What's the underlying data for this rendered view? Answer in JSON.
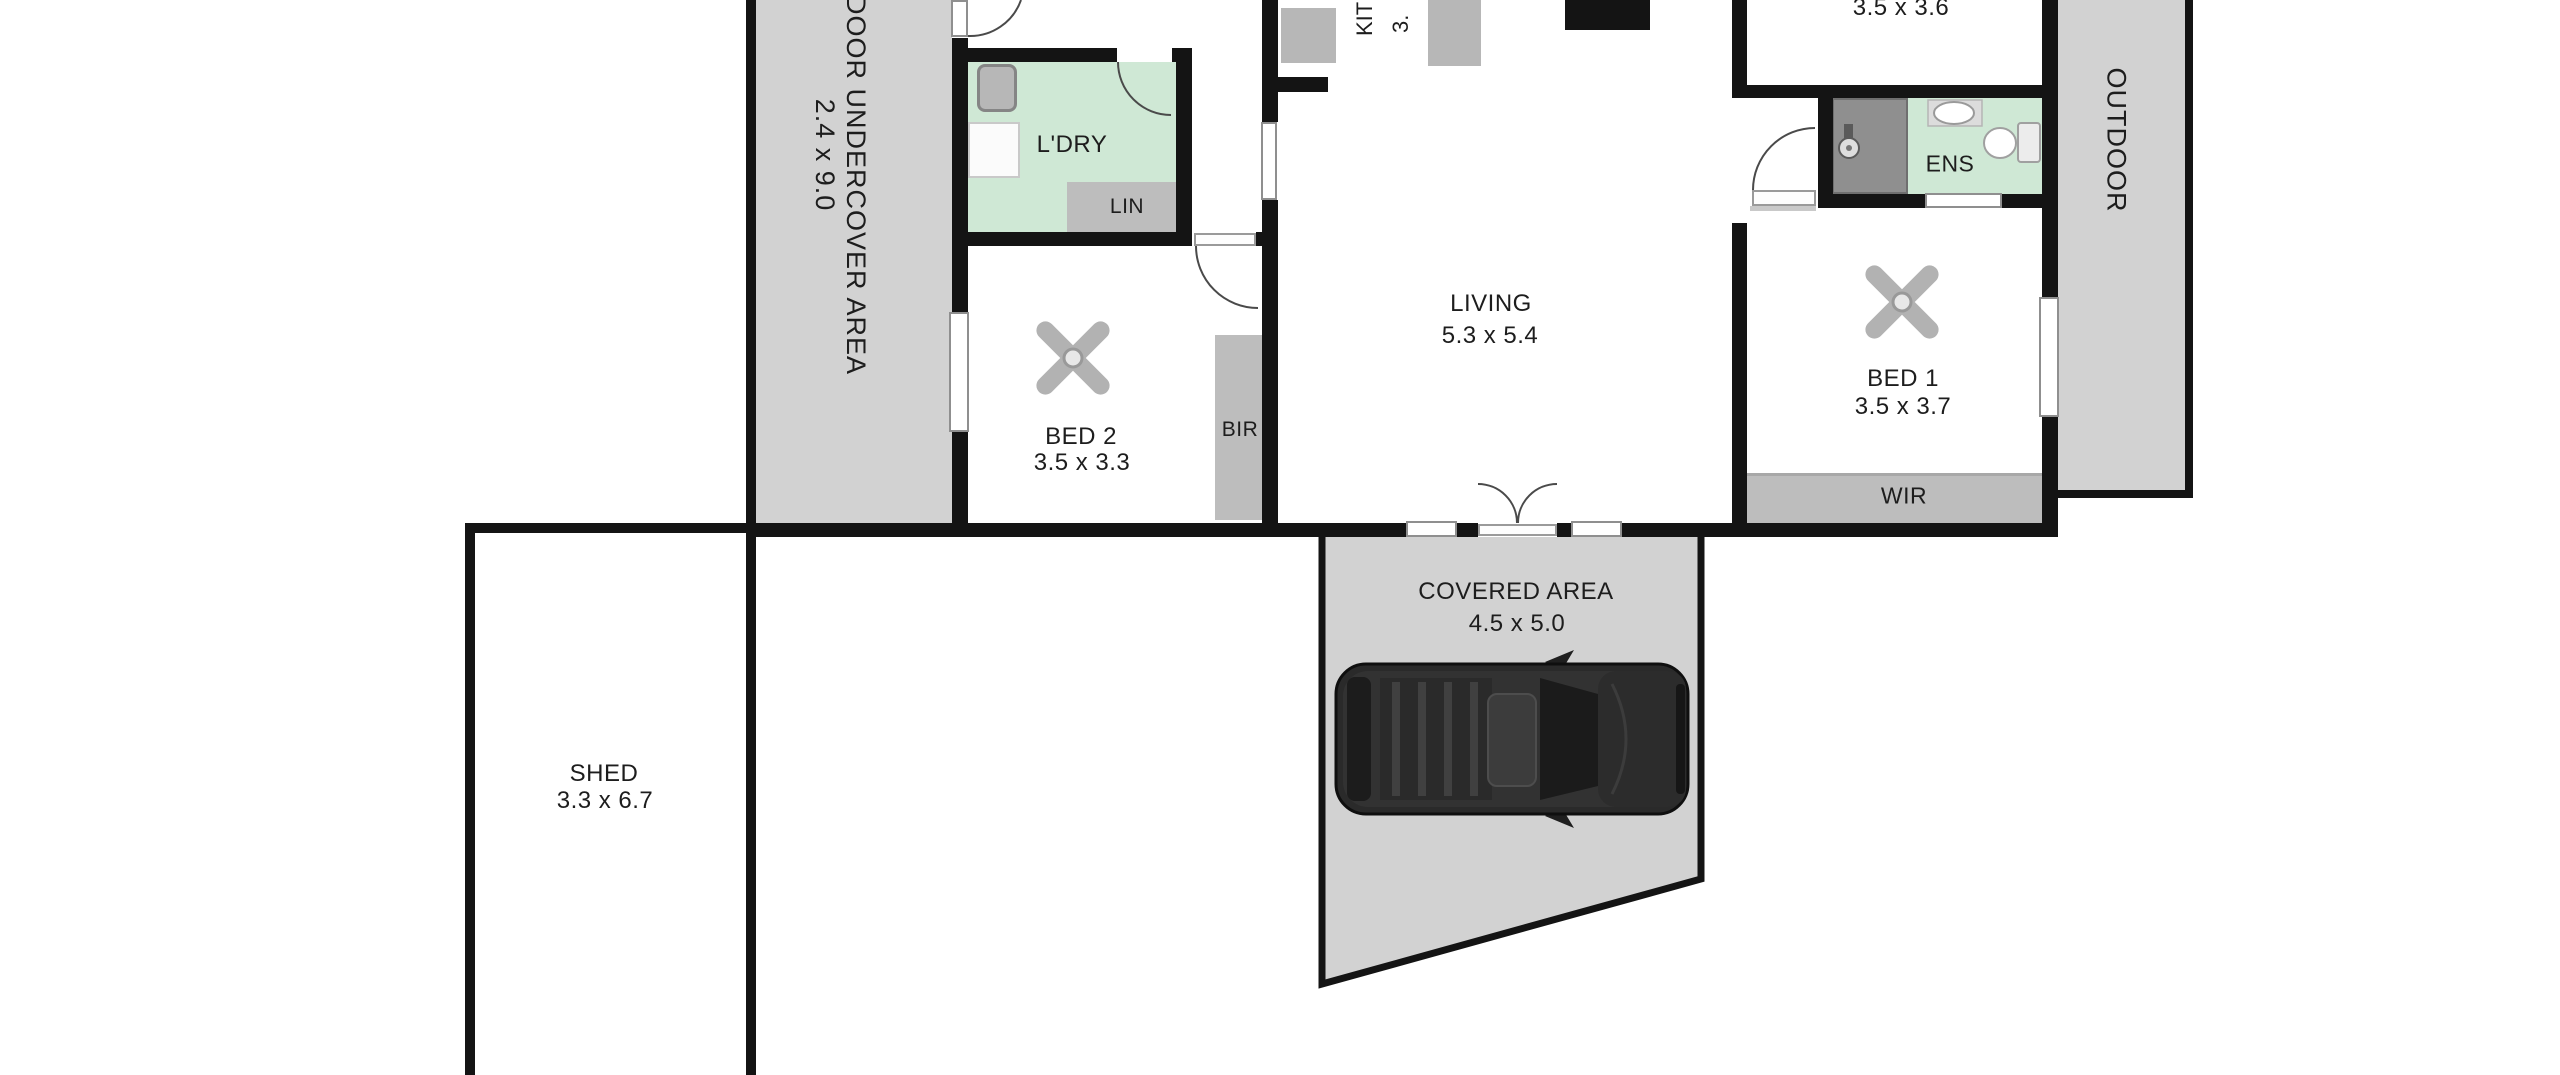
{
  "plan": {
    "outdoor_undercover": {
      "label": "OUTDOOR UNDERCOVER AREA",
      "dims": "2.4 x 9.0"
    },
    "outdoor": {
      "label": "OUTDOOR"
    },
    "covered": {
      "label": "COVERED AREA",
      "dims": "4.5 x 5.0"
    },
    "shed": {
      "label": "SHED",
      "dims": "3.3 x 6.7"
    },
    "laundry": {
      "label": "L'DRY"
    },
    "linen": {
      "label": "LIN"
    },
    "kitchen": {
      "label": "KIT",
      "dims": "3."
    },
    "living": {
      "label": "LIVING",
      "dims": "5.3 x 5.4"
    },
    "bed2": {
      "label": "BED 2",
      "dims": "3.5 x 3.3"
    },
    "bir": {
      "label": "BIR"
    },
    "bed3": {
      "dims": "3.5 x 3.6"
    },
    "ensuite": {
      "label": "ENS"
    },
    "bed1": {
      "label": "BED 1",
      "dims": "3.5 x 3.7"
    },
    "wir": {
      "label": "WIR"
    }
  },
  "colors": {
    "wall": "#141414",
    "area": "#d2d2d2",
    "feat": "#bdbdbd",
    "green": "#cfe8d5",
    "win": "#8f8f8f",
    "arc": "#4a4a4a",
    "text": "#1d1d1d",
    "car": "#2a2a2a"
  }
}
